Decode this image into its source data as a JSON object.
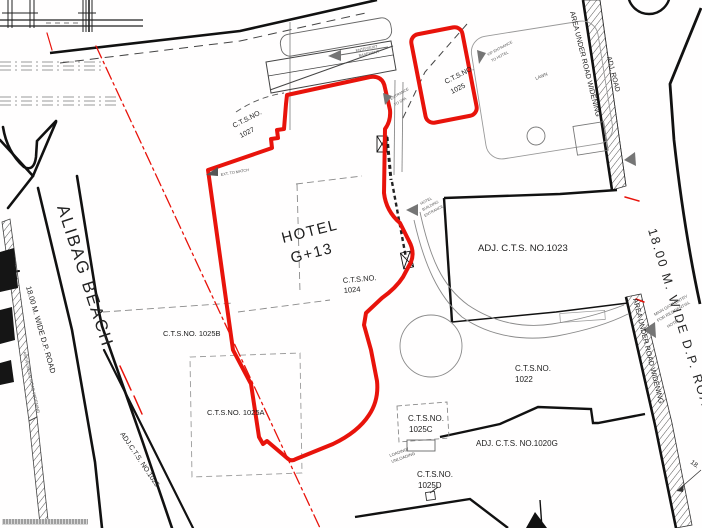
{
  "colors": {
    "plot_boundary_red": "#e8130b",
    "line_black": "#111111",
    "line_gray": "#8a8a8a",
    "arrow_gray": "#757575"
  },
  "parcels": {
    "hotel_line1": "HOTEL",
    "hotel_line2": "G+13",
    "cts1024_l1": "C.T.S.NO.",
    "cts1024_l2": "1024",
    "cts1027_l1": "C.T.S.NO.",
    "cts1027_l2": "1027",
    "cts1025_l1": "C.T.S.NO.",
    "cts1025_l2": "1025",
    "adj1023": "ADJ. C.T.S. NO.1023",
    "cts1022_l1": "C.T.S.NO.",
    "cts1022_l2": "1022",
    "cts1025b": "C.T.S.NO. 1025B",
    "cts1025a": "C.T.S.NO. 1025A",
    "cts1025c_l1": "C.T.S.NO.",
    "cts1025c_l2": "1025C",
    "cts1025d_l1": "C.T.S.NO.",
    "cts1025d_l2": "1025D",
    "adj1020g": "ADJ. C.T.S. NO.1020G",
    "adj1025": "ADJ.C.T.S. NO.1025"
  },
  "roads": {
    "alibag_beach": "ALIBAG BEACH",
    "dp_road_left": "18.00 M. WIDE D.P. ROAD",
    "dp_road_right": "18.00 M. WIDE D.P. ROAD",
    "widening_left": "AREA UNDER ROAD WIDENING",
    "widening_right_top": "AREA UNDER ROAD WIDENING",
    "widening_right_bottom": "AREA UNDER ROAD WIDENING",
    "adj_road": "ADJ. ROAD",
    "dim_right": "18."
  },
  "annotations": {
    "lawn": "LAWN",
    "ramp_l1": "ENTRY/EXIT",
    "ramp_l2": "BASEMENT",
    "spa_l1": "ENTRANCE",
    "spa_l2": "TO SPA",
    "vip_l1": "VIP ENTRANCE",
    "vip_l2": "TO HOTEL",
    "hotel_ent_l1": "HOTEL",
    "hotel_ent_l2": "BUILDING",
    "hotel_ent_l3": "ENTRANCE",
    "main_gate_l1": "MAIN GATE ENTRY",
    "main_gate_l2": "FOR RESIDENTIAL",
    "main_gate_l3": "HOTEL",
    "loading_l1": "LOADING/",
    "loading_l2": "UNLOADING",
    "ext_match": "EXT. TO MATCH"
  }
}
